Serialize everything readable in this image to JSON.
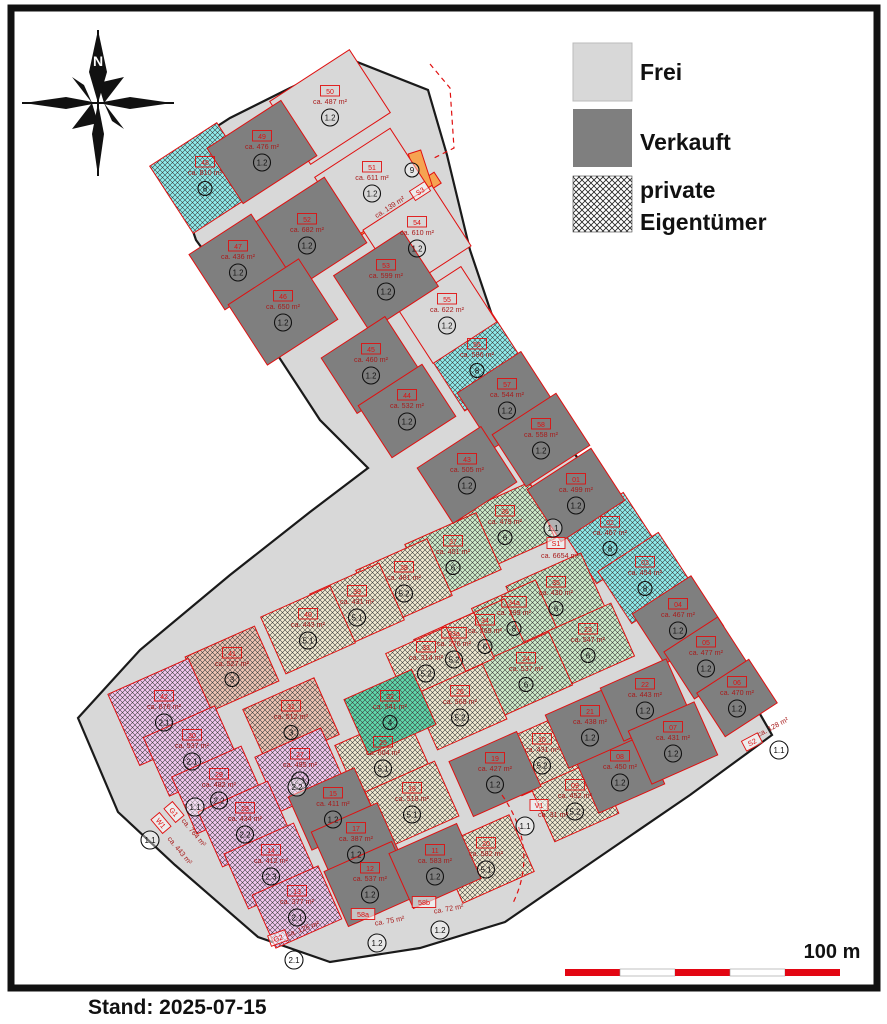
{
  "caption": "Stand: 2025-07-15",
  "legend": {
    "frei_label": "Frei",
    "verkauft_label": "Verkauft",
    "private_label_line1": "private",
    "private_label_line2": "Eigentümer"
  },
  "compass": {
    "north_label": "N"
  },
  "scalebar": {
    "label": "100 m",
    "segment_colors": [
      "#e30613",
      "#ffffff",
      "#e30613",
      "#ffffff",
      "#e30613"
    ]
  },
  "colors": {
    "solid": {
      "base": "#d8d8d8",
      "frei": "#d8d8d8",
      "sold": "#7f7f7f",
      "orange": "#f6a351"
    },
    "hatch": {
      "cyan": "#8feded",
      "green": "#cfeccb",
      "cream": "#f1ead2",
      "salmon": "#eec5b5",
      "purple": "#f3c8f0",
      "teal": "#5fd9ac"
    },
    "plot_stroke": "#e01010",
    "area_text": "#a81c1c",
    "value_text": "#111111"
  },
  "map": {
    "outline": "168,158 230,118 290,88 352,60 428,90 447,155 470,250 497,330 530,382 565,440 600,490 640,550 680,610 715,665 752,700 772,735 690,795 595,860 505,922 420,948 330,962 258,937 175,865 118,812 78,718 140,650 230,575 310,512 368,468 320,420 258,325 196,240",
    "orange_strips": [
      {
        "x": 394,
        "y": 206,
        "w": 104,
        "h": 13,
        "rot": -33
      },
      {
        "x": 421,
        "y": 172,
        "w": 13,
        "h": 42,
        "rot": -18
      }
    ],
    "plots": [
      {
        "id": "48",
        "area": "ca. 810 m²",
        "value": "8",
        "type": "cyan",
        "x": 205,
        "y": 178,
        "w": 80,
        "h": 80,
        "rot": -33
      },
      {
        "id": "56",
        "area": "ca. 586 m²",
        "value": "8",
        "type": "cyan",
        "x": 477,
        "y": 360,
        "w": 76,
        "h": 72,
        "rot": -33
      },
      {
        "id": "02",
        "area": "ca. 467 m²",
        "value": "8",
        "type": "cyan",
        "x": 610,
        "y": 538,
        "w": 72,
        "h": 62,
        "rot": -33
      },
      {
        "id": "03",
        "area": "ca. 454 m²",
        "value": "8",
        "type": "cyan",
        "x": 645,
        "y": 578,
        "w": 72,
        "h": 62,
        "rot": -33
      },
      {
        "id": "36",
        "area": "ca. 479 m²",
        "value": "6",
        "type": "green",
        "x": 505,
        "y": 527,
        "w": 82,
        "h": 62,
        "rot": -24
      },
      {
        "id": "37",
        "area": "ca. 451 m²",
        "value": "6",
        "type": "green",
        "x": 453,
        "y": 557,
        "w": 78,
        "h": 62,
        "rot": -24
      },
      {
        "id": "35",
        "area": "ca. 430 m²",
        "value": "6",
        "type": "green",
        "x": 556,
        "y": 598,
        "w": 82,
        "h": 62,
        "rot": -24
      },
      {
        "id": "34a",
        "area": "ca. 299 m²",
        "value": "8",
        "type": "green",
        "x": 514,
        "y": 618,
        "w": 70,
        "h": 52,
        "rot": -24
      },
      {
        "id": "34",
        "area": "ca. 269 m²",
        "value": "6",
        "type": "green",
        "x": 485,
        "y": 636,
        "w": 66,
        "h": 52,
        "rot": -24
      },
      {
        "id": "23",
        "area": "ca. 547 m²",
        "value": "6",
        "type": "green",
        "x": 588,
        "y": 645,
        "w": 76,
        "h": 58,
        "rot": -24
      },
      {
        "id": "24",
        "area": "ca. 537 m²",
        "value": "6",
        "type": "green",
        "x": 526,
        "y": 674,
        "w": 76,
        "h": 58,
        "rot": -24
      },
      {
        "id": "38",
        "area": "ca. 481 m²",
        "value": "5.2",
        "type": "cream",
        "x": 404,
        "y": 583,
        "w": 78,
        "h": 62,
        "rot": -24
      },
      {
        "id": "39",
        "area": "ca. 431 m²",
        "value": "5.1",
        "type": "cream",
        "x": 357,
        "y": 607,
        "w": 76,
        "h": 62,
        "rot": -24
      },
      {
        "id": "40",
        "area": "ca. 443 m²",
        "value": "5.1",
        "type": "cream",
        "x": 308,
        "y": 630,
        "w": 76,
        "h": 62,
        "rot": -24
      },
      {
        "id": "33a",
        "area": "ca. 276 m²",
        "value": "5.2",
        "type": "cream",
        "x": 454,
        "y": 649,
        "w": 66,
        "h": 50,
        "rot": -24
      },
      {
        "id": "33",
        "area": "ca. 314 m²",
        "value": "5.2",
        "type": "cream",
        "x": 426,
        "y": 663,
        "w": 66,
        "h": 50,
        "rot": -24
      },
      {
        "id": "26",
        "area": "ca. 568 m²",
        "value": "5.2",
        "type": "cream",
        "x": 460,
        "y": 707,
        "w": 76,
        "h": 60,
        "rot": -24
      },
      {
        "id": "25",
        "area": "ca. 604 m²",
        "value": "5.1",
        "type": "cream",
        "x": 383,
        "y": 758,
        "w": 78,
        "h": 62,
        "rot": -24
      },
      {
        "id": "18",
        "area": "ca. 518 m²",
        "value": "5.1",
        "type": "cream",
        "x": 412,
        "y": 804,
        "w": 76,
        "h": 60,
        "rot": -24
      },
      {
        "id": "20",
        "area": "ca. 582 m²",
        "value": "5.1",
        "type": "cream",
        "x": 486,
        "y": 859,
        "w": 78,
        "h": 62,
        "rot": -24
      },
      {
        "id": "10",
        "area": "ca. 431 m²",
        "value": "5.2",
        "type": "cream",
        "x": 542,
        "y": 755,
        "w": 70,
        "h": 58,
        "rot": -24
      },
      {
        "id": "09",
        "area": "ca. 452 m²",
        "value": "5.2",
        "type": "cream",
        "x": 575,
        "y": 801,
        "w": 70,
        "h": 58,
        "rot": -24
      },
      {
        "id": "32",
        "area": "ca. 541 m²",
        "value": "4",
        "type": "teal",
        "x": 390,
        "y": 712,
        "w": 74,
        "h": 60,
        "rot": -24
      },
      {
        "id": "41",
        "area": "ca. 527 m²",
        "value": "3",
        "type": "salmon",
        "x": 232,
        "y": 669,
        "w": 76,
        "h": 60,
        "rot": -24
      },
      {
        "id": "31",
        "area": "ca. 512 m²",
        "value": "3",
        "type": "salmon",
        "x": 291,
        "y": 722,
        "w": 78,
        "h": 62,
        "rot": -24
      },
      {
        "id": "42",
        "area": "ca. 876 m²",
        "value": "2.1",
        "type": "purple",
        "x": 164,
        "y": 712,
        "w": 88,
        "h": 78,
        "rot": -24
      },
      {
        "id": "30",
        "area": "ca. 537 m²",
        "value": "2.1",
        "type": "purple",
        "x": 192,
        "y": 751,
        "w": 78,
        "h": 64,
        "rot": -24
      },
      {
        "id": "27",
        "area": "ca. 495 m²",
        "value": "2.1",
        "type": "purple",
        "x": 300,
        "y": 770,
        "w": 72,
        "h": 60,
        "rot": -24
      },
      {
        "id": "29",
        "area": "ca. 482 m²",
        "value": "2.2",
        "type": "purple",
        "x": 219,
        "y": 790,
        "w": 76,
        "h": 62,
        "rot": -24
      },
      {
        "id": "28",
        "area": "ca. 434 m²",
        "value": "2.2",
        "type": "purple",
        "x": 245,
        "y": 824,
        "w": 76,
        "h": 60,
        "rot": -24
      },
      {
        "id": "14",
        "area": "ca. 412 m²",
        "value": "2.3",
        "type": "purple",
        "x": 271,
        "y": 866,
        "w": 76,
        "h": 60,
        "rot": -24
      },
      {
        "id": "13",
        "area": "ca. 377 m²",
        "value": "2.1",
        "type": "purple",
        "x": 297,
        "y": 907,
        "w": 72,
        "h": 58,
        "rot": -24
      },
      {
        "id": "50",
        "area": "ca. 487 m²",
        "value": "1.2",
        "type": "frei",
        "x": 330,
        "y": 107,
        "w": 95,
        "h": 75,
        "rot": -33
      },
      {
        "id": "51",
        "area": "ca. 611 m²",
        "value": "1.2",
        "type": "frei",
        "x": 372,
        "y": 183,
        "w": 90,
        "h": 72,
        "rot": -33
      },
      {
        "id": "54",
        "area": "ca. 610 m²",
        "value": "1.2",
        "type": "frei",
        "x": 417,
        "y": 238,
        "w": 82,
        "h": 72,
        "rot": -33
      },
      {
        "id": "55",
        "area": "ca. 622 m²",
        "value": "1.2",
        "type": "frei",
        "x": 447,
        "y": 315,
        "w": 76,
        "h": 66,
        "rot": -33
      },
      {
        "id": "49",
        "area": "ca. 476 m²",
        "value": "1.2",
        "type": "sold",
        "x": 262,
        "y": 152,
        "w": 88,
        "h": 66,
        "rot": -33
      },
      {
        "id": "52",
        "area": "ca. 682 m²",
        "value": "1.2",
        "type": "sold",
        "x": 307,
        "y": 235,
        "w": 92,
        "h": 78,
        "rot": -33
      },
      {
        "id": "47",
        "area": "ca. 436 m²",
        "value": "1.2",
        "type": "sold",
        "x": 238,
        "y": 262,
        "w": 74,
        "h": 66,
        "rot": -33
      },
      {
        "id": "53",
        "area": "ca. 599 m²",
        "value": "1.2",
        "type": "sold",
        "x": 386,
        "y": 281,
        "w": 82,
        "h": 66,
        "rot": -33
      },
      {
        "id": "46",
        "area": "ca. 650 m²",
        "value": "1.2",
        "type": "sold",
        "x": 283,
        "y": 312,
        "w": 84,
        "h": 72,
        "rot": -33
      },
      {
        "id": "45",
        "area": "ca. 460 m²",
        "value": "1.2",
        "type": "sold",
        "x": 371,
        "y": 365,
        "w": 76,
        "h": 66,
        "rot": -33
      },
      {
        "id": "44",
        "area": "ca. 532 m²",
        "value": "1.2",
        "type": "sold",
        "x": 407,
        "y": 411,
        "w": 76,
        "h": 62,
        "rot": -33
      },
      {
        "id": "57",
        "area": "ca. 544 m²",
        "value": "1.2",
        "type": "sold",
        "x": 507,
        "y": 400,
        "w": 76,
        "h": 66,
        "rot": -33
      },
      {
        "id": "58",
        "area": "ca. 558 m²",
        "value": "1.2",
        "type": "sold",
        "x": 541,
        "y": 440,
        "w": 76,
        "h": 62,
        "rot": -33
      },
      {
        "id": "43",
        "area": "ca. 505 m²",
        "value": "1.2",
        "type": "sold",
        "x": 467,
        "y": 475,
        "w": 76,
        "h": 66,
        "rot": -33
      },
      {
        "id": "01",
        "area": "ca. 499 m²",
        "value": "1.2",
        "type": "sold",
        "x": 576,
        "y": 495,
        "w": 76,
        "h": 62,
        "rot": -33
      },
      {
        "id": "04",
        "area": "ca. 467 m²",
        "value": "1.2",
        "type": "sold",
        "x": 678,
        "y": 620,
        "w": 70,
        "h": 60,
        "rot": -33
      },
      {
        "id": "05",
        "area": "ca. 477 m²",
        "value": "1.2",
        "type": "sold",
        "x": 706,
        "y": 658,
        "w": 64,
        "h": 56,
        "rot": -33
      },
      {
        "id": "06",
        "area": "ca. 470 m²",
        "value": "1.2",
        "type": "sold",
        "x": 737,
        "y": 698,
        "w": 62,
        "h": 52,
        "rot": -33
      },
      {
        "id": "15",
        "area": "ca. 411 m²",
        "value": "1.2",
        "type": "sold",
        "x": 333,
        "y": 809,
        "w": 72,
        "h": 58,
        "rot": -24
      },
      {
        "id": "17",
        "area": "ca. 387 m²",
        "value": "1.2",
        "type": "sold",
        "x": 356,
        "y": 844,
        "w": 72,
        "h": 58,
        "rot": -24
      },
      {
        "id": "12",
        "area": "ca. 537 m²",
        "value": "1.2",
        "type": "sold",
        "x": 370,
        "y": 884,
        "w": 74,
        "h": 60,
        "rot": -24
      },
      {
        "id": "11",
        "area": "ca. 583 m²",
        "value": "1.2",
        "type": "sold",
        "x": 435,
        "y": 866,
        "w": 74,
        "h": 60,
        "rot": -24
      },
      {
        "id": "19",
        "area": "ca. 427 m²",
        "value": "1.2",
        "type": "sold",
        "x": 495,
        "y": 774,
        "w": 74,
        "h": 60,
        "rot": -24
      },
      {
        "id": "08",
        "area": "ca. 450 m²",
        "value": "1.2",
        "type": "sold",
        "x": 620,
        "y": 772,
        "w": 72,
        "h": 58,
        "rot": -24
      },
      {
        "id": "21",
        "area": "ca. 438 m²",
        "value": "1.2",
        "type": "sold",
        "x": 590,
        "y": 727,
        "w": 72,
        "h": 58,
        "rot": -24
      },
      {
        "id": "22",
        "area": "ca. 443 m²",
        "value": "1.2",
        "type": "sold",
        "x": 645,
        "y": 700,
        "w": 72,
        "h": 58,
        "rot": -24
      },
      {
        "id": "07",
        "area": "ca. 431 m²",
        "value": "1.2",
        "type": "sold",
        "x": 673,
        "y": 743,
        "w": 72,
        "h": 58,
        "rot": -24
      }
    ],
    "special_labels": [
      {
        "id": "S3",
        "x": 420,
        "y": 191,
        "rot": -33,
        "area": "ca. 139 m²",
        "ax": 391,
        "ay": 209,
        "arot": -33
      },
      {
        "id": "S2",
        "x": 752,
        "y": 742,
        "rot": -28,
        "area": "ca. 128 m²",
        "ax": 774,
        "ay": 729,
        "arot": -28
      },
      {
        "id": "S1",
        "x": 556,
        "y": 543,
        "rot": 0,
        "area": "ca. 6654 m²",
        "ax": 560,
        "ay": 558,
        "arot": 0
      },
      {
        "id": "G1",
        "x": 174,
        "y": 812,
        "rot": 50,
        "area": "ca. 764 m²",
        "ax": 192,
        "ay": 834,
        "arot": 50
      },
      {
        "id": "W1",
        "x": 161,
        "y": 823,
        "rot": 50,
        "area": "ca. 443 m²",
        "ax": 178,
        "ay": 852,
        "arot": 50
      },
      {
        "id": "G2",
        "x": 278,
        "y": 938,
        "rot": -20,
        "area": "ca. 125 m²",
        "ax": 304,
        "ay": 931,
        "arot": -20
      },
      {
        "id": "58a",
        "x": 363,
        "y": 914,
        "rot": 0,
        "area": "ca. 75 m²",
        "ax": 390,
        "ay": 923,
        "arot": -10
      },
      {
        "id": "58b",
        "x": 424,
        "y": 902,
        "rot": 0,
        "area": "ca. 72 m²",
        "ax": 449,
        "ay": 911,
        "arot": -10
      },
      {
        "id": "V1",
        "x": 539,
        "y": 805,
        "rot": 0,
        "area": "ca. 31 m²",
        "ax": 553,
        "ay": 817,
        "arot": 0
      }
    ],
    "markers": [
      {
        "value": "9",
        "x": 412,
        "y": 170
      },
      {
        "value": "1.1",
        "x": 553,
        "y": 528
      },
      {
        "value": "1.1",
        "x": 525,
        "y": 826
      },
      {
        "value": "1.1",
        "x": 779,
        "y": 750
      },
      {
        "value": "1.1",
        "x": 150,
        "y": 840
      },
      {
        "value": "1.1",
        "x": 195,
        "y": 807
      },
      {
        "value": "2.2",
        "x": 297,
        "y": 787
      },
      {
        "value": "2.1",
        "x": 294,
        "y": 960
      },
      {
        "value": "1.2",
        "x": 377,
        "y": 943
      },
      {
        "value": "1.2",
        "x": 440,
        "y": 930
      }
    ],
    "dashed_paths": [
      "M430,64 L450,88 L454,148 L434,158",
      "M502,795 Q540,850 512,905"
    ]
  }
}
